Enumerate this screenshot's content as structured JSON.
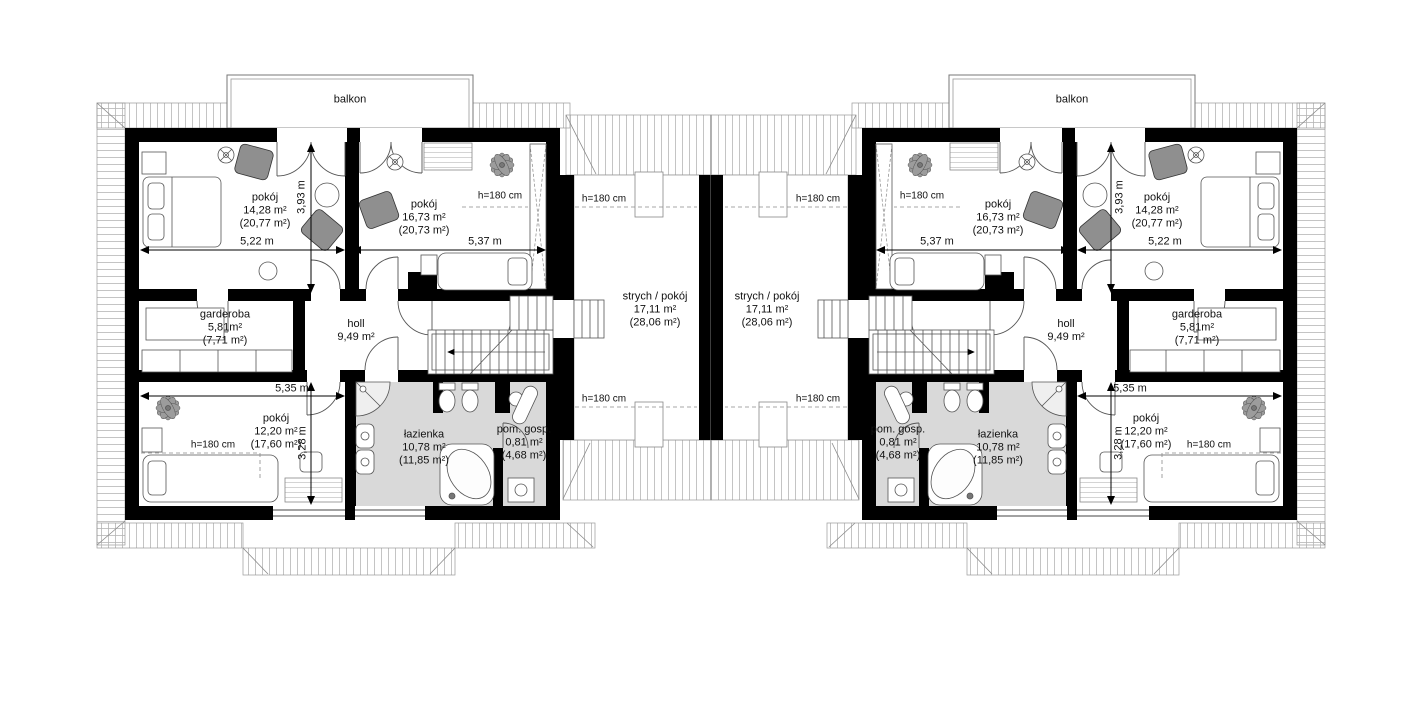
{
  "plan_title": "attic floor plan of mirrored duplex",
  "colors": {
    "wall": "#000000",
    "bathroom_fill": "#d9d9d9",
    "roof_hatch_line": "#b5b5b5",
    "furniture_accent": "#8f8f8f"
  },
  "labels": {
    "balcony": "balkon",
    "height_marker": "h=180 cm"
  },
  "rooms": {
    "bedroom_a": {
      "name": "pokój",
      "area": "14,28 m²",
      "area_floor": "(20,77 m²)"
    },
    "bedroom_b": {
      "name": "pokój",
      "area": "16,73 m²",
      "area_floor": "(20,73 m²)"
    },
    "wardrobe": {
      "name": "garderoba",
      "area": "5,81m²",
      "area_floor": "(7,71 m²)"
    },
    "hall": {
      "name": "holl",
      "area": "9,49 m²"
    },
    "bedroom_c": {
      "name": "pokój",
      "area": "12,20 m²",
      "area_floor": "(17,60 m²)"
    },
    "bathroom": {
      "name": "łazienka",
      "area": "10,78 m²",
      "area_floor": "(11,85 m²)"
    },
    "utility": {
      "name": "pom. gosp.",
      "area": "0,81 m²",
      "area_floor": "(4,68 m²)"
    },
    "attic": {
      "name": "strych / pokój",
      "area": "17,11 m²",
      "area_floor": "(28,06 m²)"
    }
  },
  "dimensions": {
    "bedroom_a_width": "5,22 m",
    "bedroom_b_width": "5,37 m",
    "bedroom_depth": "3,93 m",
    "bedroom_c_width": "5,35 m",
    "bedroom_c_depth": "3,28 m"
  }
}
